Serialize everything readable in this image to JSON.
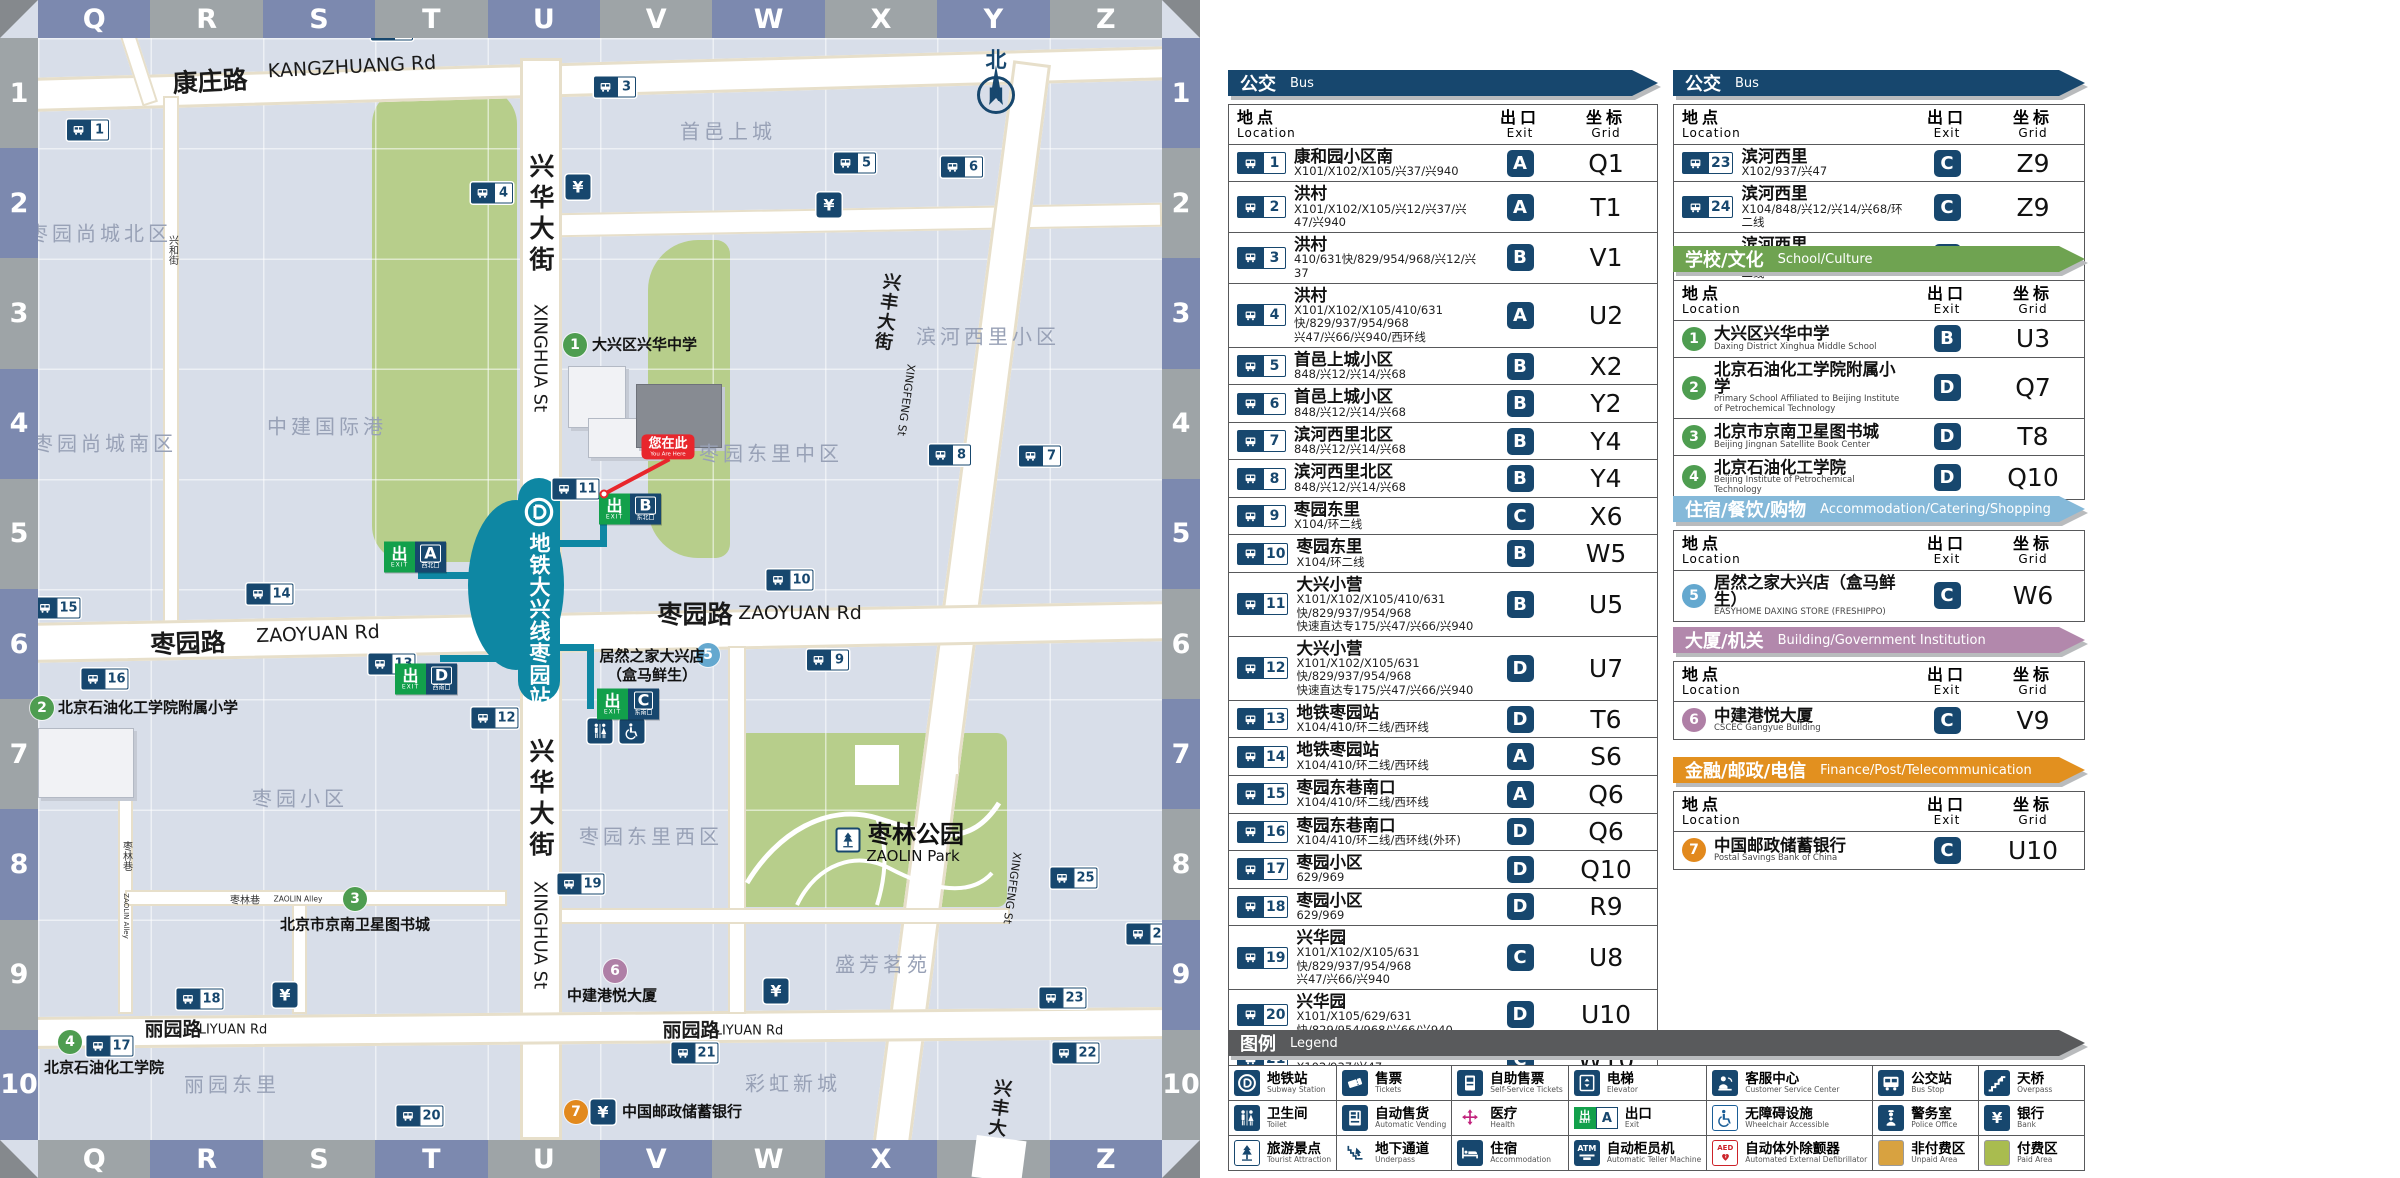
{
  "colors": {
    "navy": "#17476E",
    "teal": "#0E87A3",
    "band_blue": "#7C89AF",
    "band_gray": "#9EA4A7",
    "exit_green": "#12A04B",
    "red": "#E8262C",
    "green_area": "#B7CE8B",
    "unpaid": "#D8A240",
    "paid": "#A9BC4F"
  },
  "map": {
    "grid": {
      "cols": [
        "Q",
        "R",
        "S",
        "T",
        "U",
        "V",
        "W",
        "X",
        "Y",
        "Z"
      ],
      "rows": [
        "1",
        "2",
        "3",
        "4",
        "5",
        "6",
        "7",
        "8",
        "9",
        "10"
      ]
    },
    "compass": {
      "north_zh": "北",
      "north_letter": "N"
    },
    "station": {
      "name_zh": "地铁大兴线枣园站"
    },
    "you_are_here": {
      "zh": "您在此",
      "en": "You Are Here"
    },
    "bank_symbol": "¥",
    "bus_stops": [
      {
        "n": 1,
        "x": 88,
        "y": 130
      },
      {
        "n": 2,
        "x": 392,
        "y": 30
      },
      {
        "n": 3,
        "x": 615,
        "y": 87
      },
      {
        "n": 4,
        "x": 492,
        "y": 193
      },
      {
        "n": 5,
        "x": 855,
        "y": 163
      },
      {
        "n": 6,
        "x": 962,
        "y": 167
      },
      {
        "n": 7,
        "x": 1040,
        "y": 456
      },
      {
        "n": 8,
        "x": 950,
        "y": 455
      },
      {
        "n": 9,
        "x": 828,
        "y": 660
      },
      {
        "n": 10,
        "x": 790,
        "y": 580
      },
      {
        "n": 11,
        "x": 576,
        "y": 489
      },
      {
        "n": 12,
        "x": 495,
        "y": 718
      },
      {
        "n": 13,
        "x": 392,
        "y": 664
      },
      {
        "n": 14,
        "x": 270,
        "y": 594
      },
      {
        "n": 15,
        "x": 57,
        "y": 608
      },
      {
        "n": 16,
        "x": 105,
        "y": 679
      },
      {
        "n": 17,
        "x": 110,
        "y": 1046
      },
      {
        "n": 18,
        "x": 200,
        "y": 999
      },
      {
        "n": 19,
        "x": 581,
        "y": 884
      },
      {
        "n": 20,
        "x": 420,
        "y": 1116
      },
      {
        "n": 21,
        "x": 695,
        "y": 1053
      },
      {
        "n": 22,
        "x": 1076,
        "y": 1053
      },
      {
        "n": 23,
        "x": 1063,
        "y": 998
      },
      {
        "n": 24,
        "x": 1150,
        "y": 934
      },
      {
        "n": 25,
        "x": 1074,
        "y": 878
      }
    ],
    "banks": [
      {
        "x": 578,
        "y": 187
      },
      {
        "x": 829,
        "y": 205
      },
      {
        "x": 285,
        "y": 995
      },
      {
        "x": 776,
        "y": 991
      }
    ],
    "facilities": [
      {
        "icon": "toilet",
        "x": 600,
        "y": 731
      },
      {
        "icon": "wheelchair-accessible",
        "x": 632,
        "y": 731
      }
    ],
    "park_icon": {
      "icon": "tourist-attraction",
      "x": 848,
      "y": 840
    },
    "exits": [
      {
        "letter": "A",
        "caption": "西北口",
        "x": 415,
        "y": 557
      },
      {
        "letter": "B",
        "caption": "东北口",
        "x": 630,
        "y": 509
      },
      {
        "letter": "C",
        "caption": "东南口",
        "x": 628,
        "y": 704
      },
      {
        "letter": "D",
        "caption": "西南口",
        "x": 426,
        "y": 679
      }
    ],
    "pois": [
      {
        "n": 1,
        "color": "#4E9D50",
        "x": 575,
        "y": 345,
        "lines": [
          "大兴区兴华中学"
        ],
        "lx": 592,
        "ly": 345,
        "anchor": "left"
      },
      {
        "n": 2,
        "color": "#4E9D50",
        "x": 42,
        "y": 708,
        "lines": [
          "北京石油化工学院附属小学"
        ],
        "lx": 58,
        "ly": 708,
        "anchor": "left"
      },
      {
        "n": 3,
        "color": "#4E9D50",
        "x": 355,
        "y": 899,
        "lines": [
          "北京市京南卫星图书城"
        ],
        "lx": 355,
        "ly": 925,
        "anchor": "center"
      },
      {
        "n": 4,
        "color": "#4E9D50",
        "x": 70,
        "y": 1042,
        "lines": [
          "北京石油化工学院"
        ],
        "lx": 44,
        "ly": 1068,
        "anchor": "left"
      },
      {
        "n": 5,
        "color": "#64A8CF",
        "x": 708,
        "y": 655,
        "lines": [
          "居然之家大兴店",
          "（盒马鲜生）"
        ],
        "lx": 652,
        "ly": 666,
        "anchor": "center"
      },
      {
        "n": 6,
        "color": "#AF7FA6",
        "x": 615,
        "y": 971,
        "lines": [
          "中建港悦大厦"
        ],
        "lx": 612,
        "ly": 996,
        "anchor": "center"
      },
      {
        "n": 7,
        "color": "#E2891D",
        "x": 576,
        "y": 1112,
        "lines": [
          "中国邮政储蓄银行"
        ],
        "lx": 622,
        "ly": 1112,
        "anchor": "left",
        "bank": true
      }
    ],
    "area_labels": [
      {
        "t": "枣园尚城北区",
        "x": 100,
        "y": 232
      },
      {
        "t": "枣园尚城南区",
        "x": 105,
        "y": 442
      },
      {
        "t": "中建国际港",
        "x": 327,
        "y": 425
      },
      {
        "t": "首邑上城",
        "x": 728,
        "y": 130
      },
      {
        "t": "滨河西里小区",
        "x": 988,
        "y": 335
      },
      {
        "t": "枣园东里中区",
        "x": 771,
        "y": 452
      },
      {
        "t": "枣园小区",
        "x": 300,
        "y": 797
      },
      {
        "t": "枣园东里西区",
        "x": 651,
        "y": 835
      },
      {
        "t": "盛芳茗苑",
        "x": 883,
        "y": 963
      },
      {
        "t": "彩虹新城",
        "x": 793,
        "y": 1082
      },
      {
        "t": "丽园东里",
        "x": 232,
        "y": 1083
      }
    ],
    "road_labels": [
      {
        "t": "康庄路",
        "x": 210,
        "y": 80,
        "cls": "rl-zh",
        "rot": -3
      },
      {
        "t": "KANGZHUANG Rd",
        "x": 352,
        "y": 67,
        "cls": "rl-en",
        "rot": -3
      },
      {
        "t": "枣园路",
        "x": 188,
        "y": 642,
        "cls": "rl-zh",
        "rot": -2
      },
      {
        "t": "ZAOYUAN Rd",
        "x": 318,
        "y": 634,
        "cls": "rl-en",
        "rot": -2
      },
      {
        "t": "枣园路",
        "x": 695,
        "y": 613,
        "cls": "rl-zh"
      },
      {
        "t": "ZAOYUAN Rd",
        "x": 800,
        "y": 613,
        "cls": "rl-en"
      },
      {
        "t": "丽园路",
        "x": 173,
        "y": 1028,
        "cls": "rl-zh-sm"
      },
      {
        "t": "LIYUAN Rd",
        "x": 233,
        "y": 1030,
        "cls": "rl-en-sm"
      },
      {
        "t": "丽园路",
        "x": 691,
        "y": 1029,
        "cls": "rl-zh-sm"
      },
      {
        "t": "LIYUAN Rd",
        "x": 749,
        "y": 1031,
        "cls": "rl-en-sm"
      },
      {
        "t": "兴华大街",
        "x": 540,
        "y": 215,
        "cls": "rl-zh-v"
      },
      {
        "t": "XINGHUA St",
        "x": 540,
        "y": 358,
        "cls": "rl-en-v"
      },
      {
        "t": "兴华大街",
        "x": 540,
        "y": 800,
        "cls": "rl-zh-v"
      },
      {
        "t": "XINGHUA St",
        "x": 540,
        "y": 935,
        "cls": "rl-en-v"
      },
      {
        "t": "兴丰大街",
        "x": 886,
        "y": 312,
        "cls": "rl-zh-v-sm",
        "rot": 8
      },
      {
        "t": "XINGFENG St",
        "x": 906,
        "y": 400,
        "cls": "rl-en-v-xs",
        "rot": 8
      },
      {
        "t": "兴丰大街",
        "x": 997,
        "y": 1118,
        "cls": "rl-zh-v-sm",
        "rot": 8
      },
      {
        "t": "XINGFENG St",
        "x": 1012,
        "y": 888,
        "cls": "rl-en-v-xs",
        "rot": 8
      },
      {
        "t": "兴和街",
        "x": 172,
        "y": 250,
        "cls": "rl-zh-v-xs"
      },
      {
        "t": "枣林巷",
        "x": 126,
        "y": 856,
        "cls": "rl-zh-v-xs"
      },
      {
        "t": "ZAOLIN Alley",
        "x": 126,
        "y": 916,
        "cls": "rl-en-v-xxs"
      },
      {
        "t": "枣林巷",
        "x": 245,
        "y": 899,
        "cls": "rl-zh-xs"
      },
      {
        "t": "ZAOLIN Alley",
        "x": 298,
        "y": 899,
        "cls": "rl-en-xxs"
      }
    ],
    "park_labels": [
      {
        "t": "枣林公园",
        "x": 916,
        "y": 832,
        "cls": "park-zh"
      },
      {
        "t": "ZAOLIN Park",
        "x": 913,
        "y": 856,
        "cls": "park-en"
      }
    ]
  },
  "panel": {
    "headers": {
      "location_zh": "地点",
      "location_en": "Location",
      "exit_zh": "出口",
      "exit_en": "Exit",
      "grid_zh": "坐标",
      "grid_en": "Grid"
    },
    "sections": [
      {
        "id": "bus-main",
        "col": "left",
        "top": 70,
        "title_zh": "公交",
        "title_en": "Bus",
        "color": "#17476E",
        "marker": "bus",
        "rows": [
          {
            "n": 1,
            "name": "康和园小区南",
            "routes": [
              "X101/X102/X105/兴37/兴940"
            ],
            "exit": "A",
            "grid": "Q1"
          },
          {
            "n": 2,
            "name": "洪村",
            "routes": [
              "X101/X102/X105/兴12/兴37/兴47/兴940"
            ],
            "exit": "A",
            "grid": "T1"
          },
          {
            "n": 3,
            "name": "洪村",
            "routes": [
              "410/631快/829/954/968/兴12/兴37"
            ],
            "exit": "B",
            "grid": "V1"
          },
          {
            "n": 4,
            "name": "洪村",
            "routes": [
              "X101/X102/X105/410/631快/829/937/954/968",
              "兴47/兴66/兴940/西环线"
            ],
            "exit": "A",
            "grid": "U2"
          },
          {
            "n": 5,
            "name": "首邑上城小区",
            "routes": [
              "848/兴12/兴14/兴68"
            ],
            "exit": "B",
            "grid": "X2"
          },
          {
            "n": 6,
            "name": "首邑上城小区",
            "routes": [
              "848/兴12/兴14/兴68"
            ],
            "exit": "B",
            "grid": "Y2"
          },
          {
            "n": 7,
            "name": "滨河西里北区",
            "routes": [
              "848/兴12/兴14/兴68"
            ],
            "exit": "B",
            "grid": "Y4"
          },
          {
            "n": 8,
            "name": "滨河西里北区",
            "routes": [
              "848/兴12/兴14/兴68"
            ],
            "exit": "B",
            "grid": "Y4"
          },
          {
            "n": 9,
            "name": "枣园东里",
            "routes": [
              "X104/环二线"
            ],
            "exit": "C",
            "grid": "X6"
          },
          {
            "n": 10,
            "name": "枣园东里",
            "routes": [
              "X104/环二线"
            ],
            "exit": "B",
            "grid": "W5"
          },
          {
            "n": 11,
            "name": "大兴小营",
            "routes": [
              "X101/X102/X105/410/631快/829/937/954/968",
              "快速直达专175/兴47/兴66/兴940"
            ],
            "exit": "B",
            "grid": "U5"
          },
          {
            "n": 12,
            "name": "大兴小营",
            "routes": [
              "X101/X102/X105/631快/829/937/954/968",
              "快速直达专175/兴47/兴66/兴940"
            ],
            "exit": "D",
            "grid": "U7"
          },
          {
            "n": 13,
            "name": "地铁枣园站",
            "routes": [
              "X104/410/环二线/西环线"
            ],
            "exit": "D",
            "grid": "T6"
          },
          {
            "n": 14,
            "name": "地铁枣园站",
            "routes": [
              "X104/410/环二线/西环线"
            ],
            "exit": "A",
            "grid": "S6"
          },
          {
            "n": 15,
            "name": "枣园东巷南口",
            "routes": [
              "X104/410/环二线/西环线"
            ],
            "exit": "A",
            "grid": "Q6"
          },
          {
            "n": 16,
            "name": "枣园东巷南口",
            "routes": [
              "X104/410/环二线/西环线(外环)"
            ],
            "exit": "D",
            "grid": "Q6"
          },
          {
            "n": 17,
            "name": "枣园小区",
            "routes": [
              "629/969"
            ],
            "exit": "D",
            "grid": "Q10"
          },
          {
            "n": 18,
            "name": "枣园小区",
            "routes": [
              "629/969"
            ],
            "exit": "D",
            "grid": "R9"
          },
          {
            "n": 19,
            "name": "兴华园",
            "routes": [
              "X101/X102/X105/631快/829/937/954/968",
              "兴47/兴66/兴940"
            ],
            "exit": "C",
            "grid": "U8"
          },
          {
            "n": 20,
            "name": "兴华园",
            "routes": [
              "X101/X105/629/631快/829/954/968/兴66/兴940"
            ],
            "exit": "D",
            "grid": "U10"
          },
          {
            "n": 21,
            "name": "兴华园",
            "routes": [
              "X102/937/兴47"
            ],
            "exit": "C",
            "grid": "W10"
          },
          {
            "n": 22,
            "name": "滨河西里",
            "routes": [
              "X102/937/兴47"
            ],
            "exit": "C",
            "grid": "Z10"
          }
        ]
      },
      {
        "id": "bus-extra",
        "col": "right",
        "top": 70,
        "title_zh": "公交",
        "title_en": "Bus",
        "color": "#17476E",
        "marker": "bus",
        "rows": [
          {
            "n": 23,
            "name": "滨河西里",
            "routes": [
              "X102/937/兴47"
            ],
            "exit": "C",
            "grid": "Z9"
          },
          {
            "n": 24,
            "name": "滨河西里",
            "routes": [
              "X104/848/兴12/兴14/兴68/环二线"
            ],
            "exit": "C",
            "grid": "Z9"
          },
          {
            "n": 25,
            "name": "滨河西里",
            "routes": [
              "X104/848/兴12/兴14/兴68/环二线"
            ],
            "exit": "C",
            "grid": "Z8"
          }
        ]
      },
      {
        "id": "school",
        "col": "right",
        "top": 246,
        "title_zh": "学校/文化",
        "title_en": "School/Culture",
        "color": "#6FA351",
        "marker": "poi",
        "poi_color": "#4E9D50",
        "rows": [
          {
            "n": 1,
            "name": "大兴区兴华中学",
            "sub": "Daxing District Xinghua Middle School",
            "exit": "B",
            "grid": "U3"
          },
          {
            "n": 2,
            "name": "北京石油化工学院附属小学",
            "sub": "Primary School Affiliated to Beijing Institute of Petrochemical Technology",
            "exit": "D",
            "grid": "Q7"
          },
          {
            "n": 3,
            "name": "北京市京南卫星图书城",
            "sub": "Beijing Jingnan Satellite Book Center",
            "exit": "D",
            "grid": "T8"
          },
          {
            "n": 4,
            "name": "北京石油化工学院",
            "sub": "Beijing Institute of Petrochemical Technology",
            "exit": "D",
            "grid": "Q10"
          }
        ]
      },
      {
        "id": "accommodation",
        "col": "right",
        "top": 496,
        "title_zh": "住宿/餐饮/购物",
        "title_en": "Accommodation/Catering/Shopping",
        "color": "#85B9D9",
        "marker": "poi",
        "poi_color": "#64A8CF",
        "rows": [
          {
            "n": 5,
            "name": "居然之家大兴店（盒马鲜生）",
            "sub": "EASYHOME DAXING STORE (FRESHIPPO)",
            "exit": "C",
            "grid": "W6"
          }
        ]
      },
      {
        "id": "building",
        "col": "right",
        "top": 627,
        "title_zh": "大厦/机关",
        "title_en": "Building/Government Institution",
        "color": "#B288AC",
        "marker": "poi",
        "poi_color": "#AF7FA6",
        "rows": [
          {
            "n": 6,
            "name": "中建港悦大厦",
            "sub": "CSCEC Gangyue Building",
            "exit": "C",
            "grid": "V9"
          }
        ]
      },
      {
        "id": "finance",
        "col": "right",
        "top": 757,
        "title_zh": "金融/邮政/电信",
        "title_en": "Finance/Post/Telecommunication",
        "color": "#E2901F",
        "marker": "poi",
        "poi_color": "#E2891D",
        "rows": [
          {
            "n": 7,
            "name": "中国邮政储蓄银行",
            "sub": "Postal Savings Bank of China",
            "exit": "C",
            "grid": "U10"
          }
        ]
      }
    ],
    "legend": {
      "title_zh": "图例",
      "title_en": "Legend",
      "color": "#595A5C",
      "items": [
        {
          "icon": "subway-station",
          "zh": "地铁站",
          "en": "Subway Station"
        },
        {
          "icon": "tickets",
          "zh": "售票",
          "en": "Tickets"
        },
        {
          "icon": "self-service-tickets",
          "zh": "自助售票",
          "en": "Self-Service Tickets"
        },
        {
          "icon": "elevator",
          "zh": "电梯",
          "en": "Elevator"
        },
        {
          "icon": "customer-service-center",
          "zh": "客服中心",
          "en": "Customer Service Center"
        },
        {
          "icon": "bus-stop",
          "zh": "公交站",
          "en": "Bus Stop"
        },
        {
          "icon": "overpass",
          "zh": "天桥",
          "en": "Overpass"
        },
        {
          "icon": "toilet",
          "zh": "卫生间",
          "en": "Toilet"
        },
        {
          "icon": "automatic-vending",
          "zh": "自动售货",
          "en": "Automatic Vending"
        },
        {
          "icon": "health",
          "zh": "医疗",
          "en": "Health"
        },
        {
          "icon": "exit",
          "zh": "出口",
          "en": "Exit"
        },
        {
          "icon": "wheelchair-accessible",
          "zh": "无障碍设施",
          "en": "Wheelchair Accessible"
        },
        {
          "icon": "police-office",
          "zh": "警务室",
          "en": "Police Office"
        },
        {
          "icon": "bank",
          "zh": "银行",
          "en": "Bank"
        },
        {
          "icon": "tourist-attraction",
          "zh": "旅游景点",
          "en": "Tourist Attraction"
        },
        {
          "icon": "underpass",
          "zh": "地下通道",
          "en": "Underpass"
        },
        {
          "icon": "accommodation",
          "zh": "住宿",
          "en": "Accommodation"
        },
        {
          "icon": "atm",
          "zh": "自动柜员机",
          "en": "Automatic Teller Machine"
        },
        {
          "icon": "aed",
          "zh": "自动体外除颤器",
          "en": "Automated External Defibrillator"
        },
        {
          "icon": "unpaid-area",
          "zh": "非付费区",
          "en": "Unpaid Area"
        },
        {
          "icon": "paid-area",
          "zh": "付费区",
          "en": "Paid Area"
        }
      ]
    }
  }
}
